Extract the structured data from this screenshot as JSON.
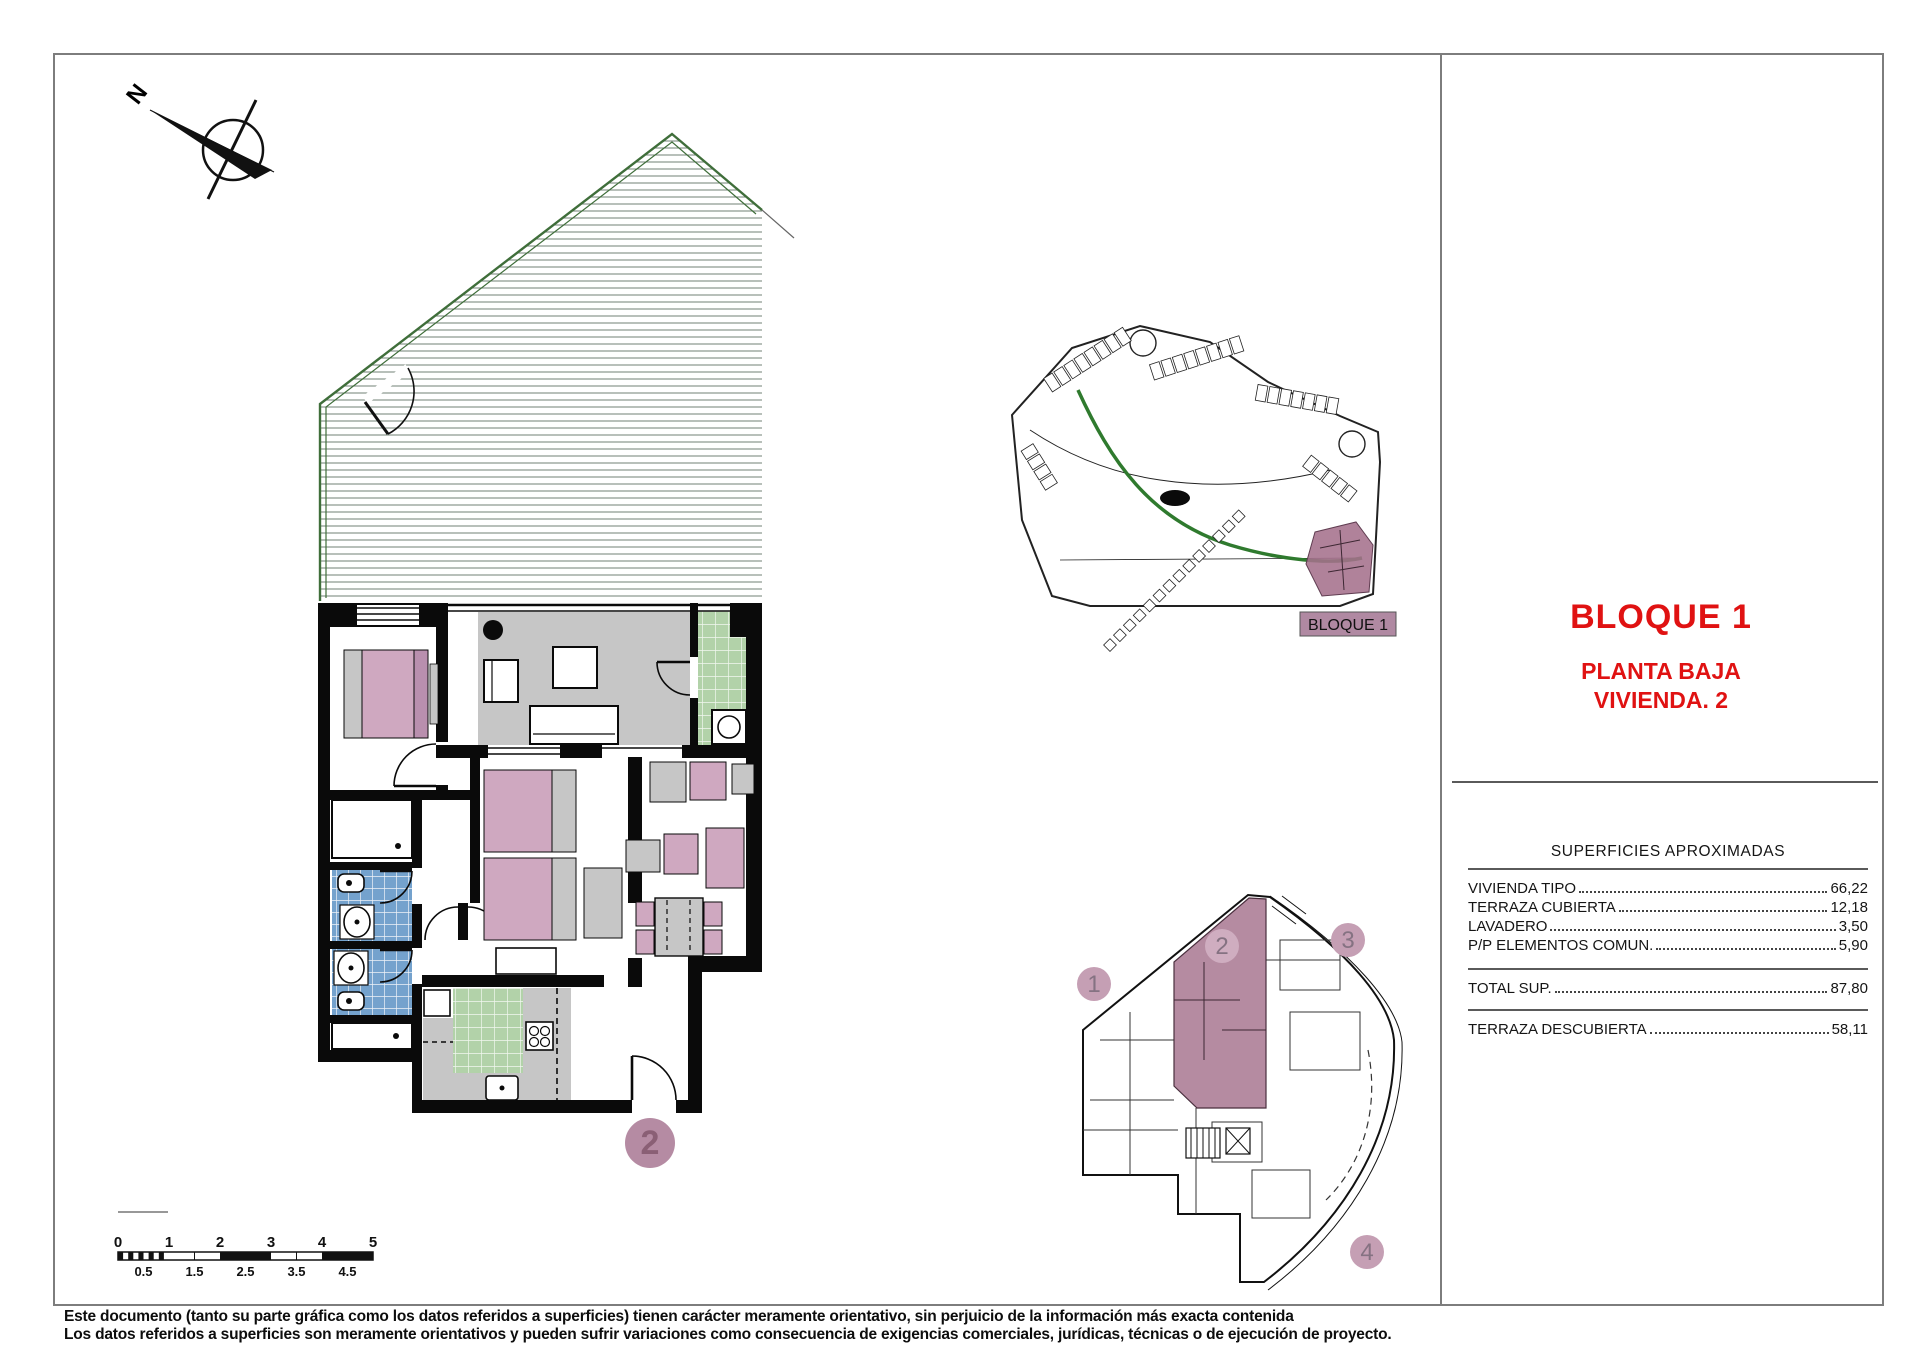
{
  "title_block": {
    "block": "BLOQUE 1",
    "floor": "PLANTA BAJA",
    "unit": "VIVIENDA. 2"
  },
  "surfaces_table": {
    "title": "SUPERFICIES APROXIMADAS",
    "rows": [
      {
        "label": "VIVIENDA TIPO",
        "value": "66,22"
      },
      {
        "label": "TERRAZA CUBIERTA",
        "value": "12,18"
      },
      {
        "label": "LAVADERO",
        "value": "3,50"
      },
      {
        "label": "P/P ELEMENTOS COMUN.",
        "value": "5,90"
      }
    ],
    "total": {
      "label": "TOTAL SUP.",
      "value": "87,80"
    },
    "uncovered": {
      "label": "TERRAZA DESCUBIERTA",
      "value": "58,11"
    }
  },
  "site_plan": {
    "label": "BLOQUE 1"
  },
  "key_plan": {
    "units": [
      "1",
      "2",
      "3",
      "4"
    ],
    "highlighted_unit": "2"
  },
  "floor_plan": {
    "unit_badge": "2"
  },
  "compass": {
    "north_label": "N"
  },
  "scale_bar": {
    "major_ticks": [
      "0",
      "1",
      "2",
      "3",
      "4",
      "5"
    ],
    "minor_ticks": [
      "0.5",
      "1.5",
      "2.5",
      "3.5",
      "4.5"
    ]
  },
  "disclaimer": {
    "line1": "Este documento (tanto su parte gráfica como los datos referidos a superficies) tienen carácter meramente orientativo, sin perjuicio de la información más exacta contenida",
    "line2": "Los datos referidos a superficies son meramente orientativos y pueden sufrir variaciones como consecuencia de exigencias comerciales, jurídicas, técnicas o de ejecución de proyecto."
  },
  "colors": {
    "accent_red": "#e01212",
    "highlight_mauve": "#a5718c",
    "furniture_pink": "#cfa8c0",
    "tile_blue": "#74a2cd",
    "tile_green": "#b2d2a9",
    "floor_gray": "#c6c6c6",
    "terrace_green": "#3f6e3a"
  }
}
